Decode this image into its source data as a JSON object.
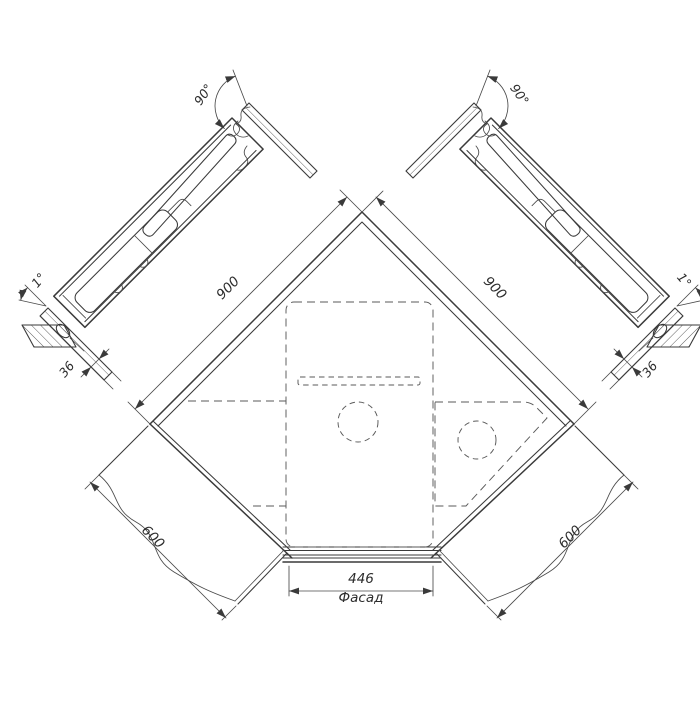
{
  "drawing": {
    "kind": "corner-cabinet-technical-drawing",
    "colors": {
      "background": "#ffffff",
      "line": "#3a3a3a",
      "text": "#2c2c2c"
    },
    "plan": {
      "dim_wall_left": "900",
      "dim_wall_right": "900",
      "dim_run_left": "600",
      "dim_run_right": "600",
      "dim_facade_width": "446",
      "facade_caption": "Фасад"
    },
    "sections": {
      "left": {
        "opening_angle": "90°",
        "tilt_angle": "1°",
        "panel_thickness": "36"
      },
      "right": {
        "opening_angle": "90°",
        "tilt_angle": "1°",
        "panel_thickness": "36"
      }
    }
  }
}
